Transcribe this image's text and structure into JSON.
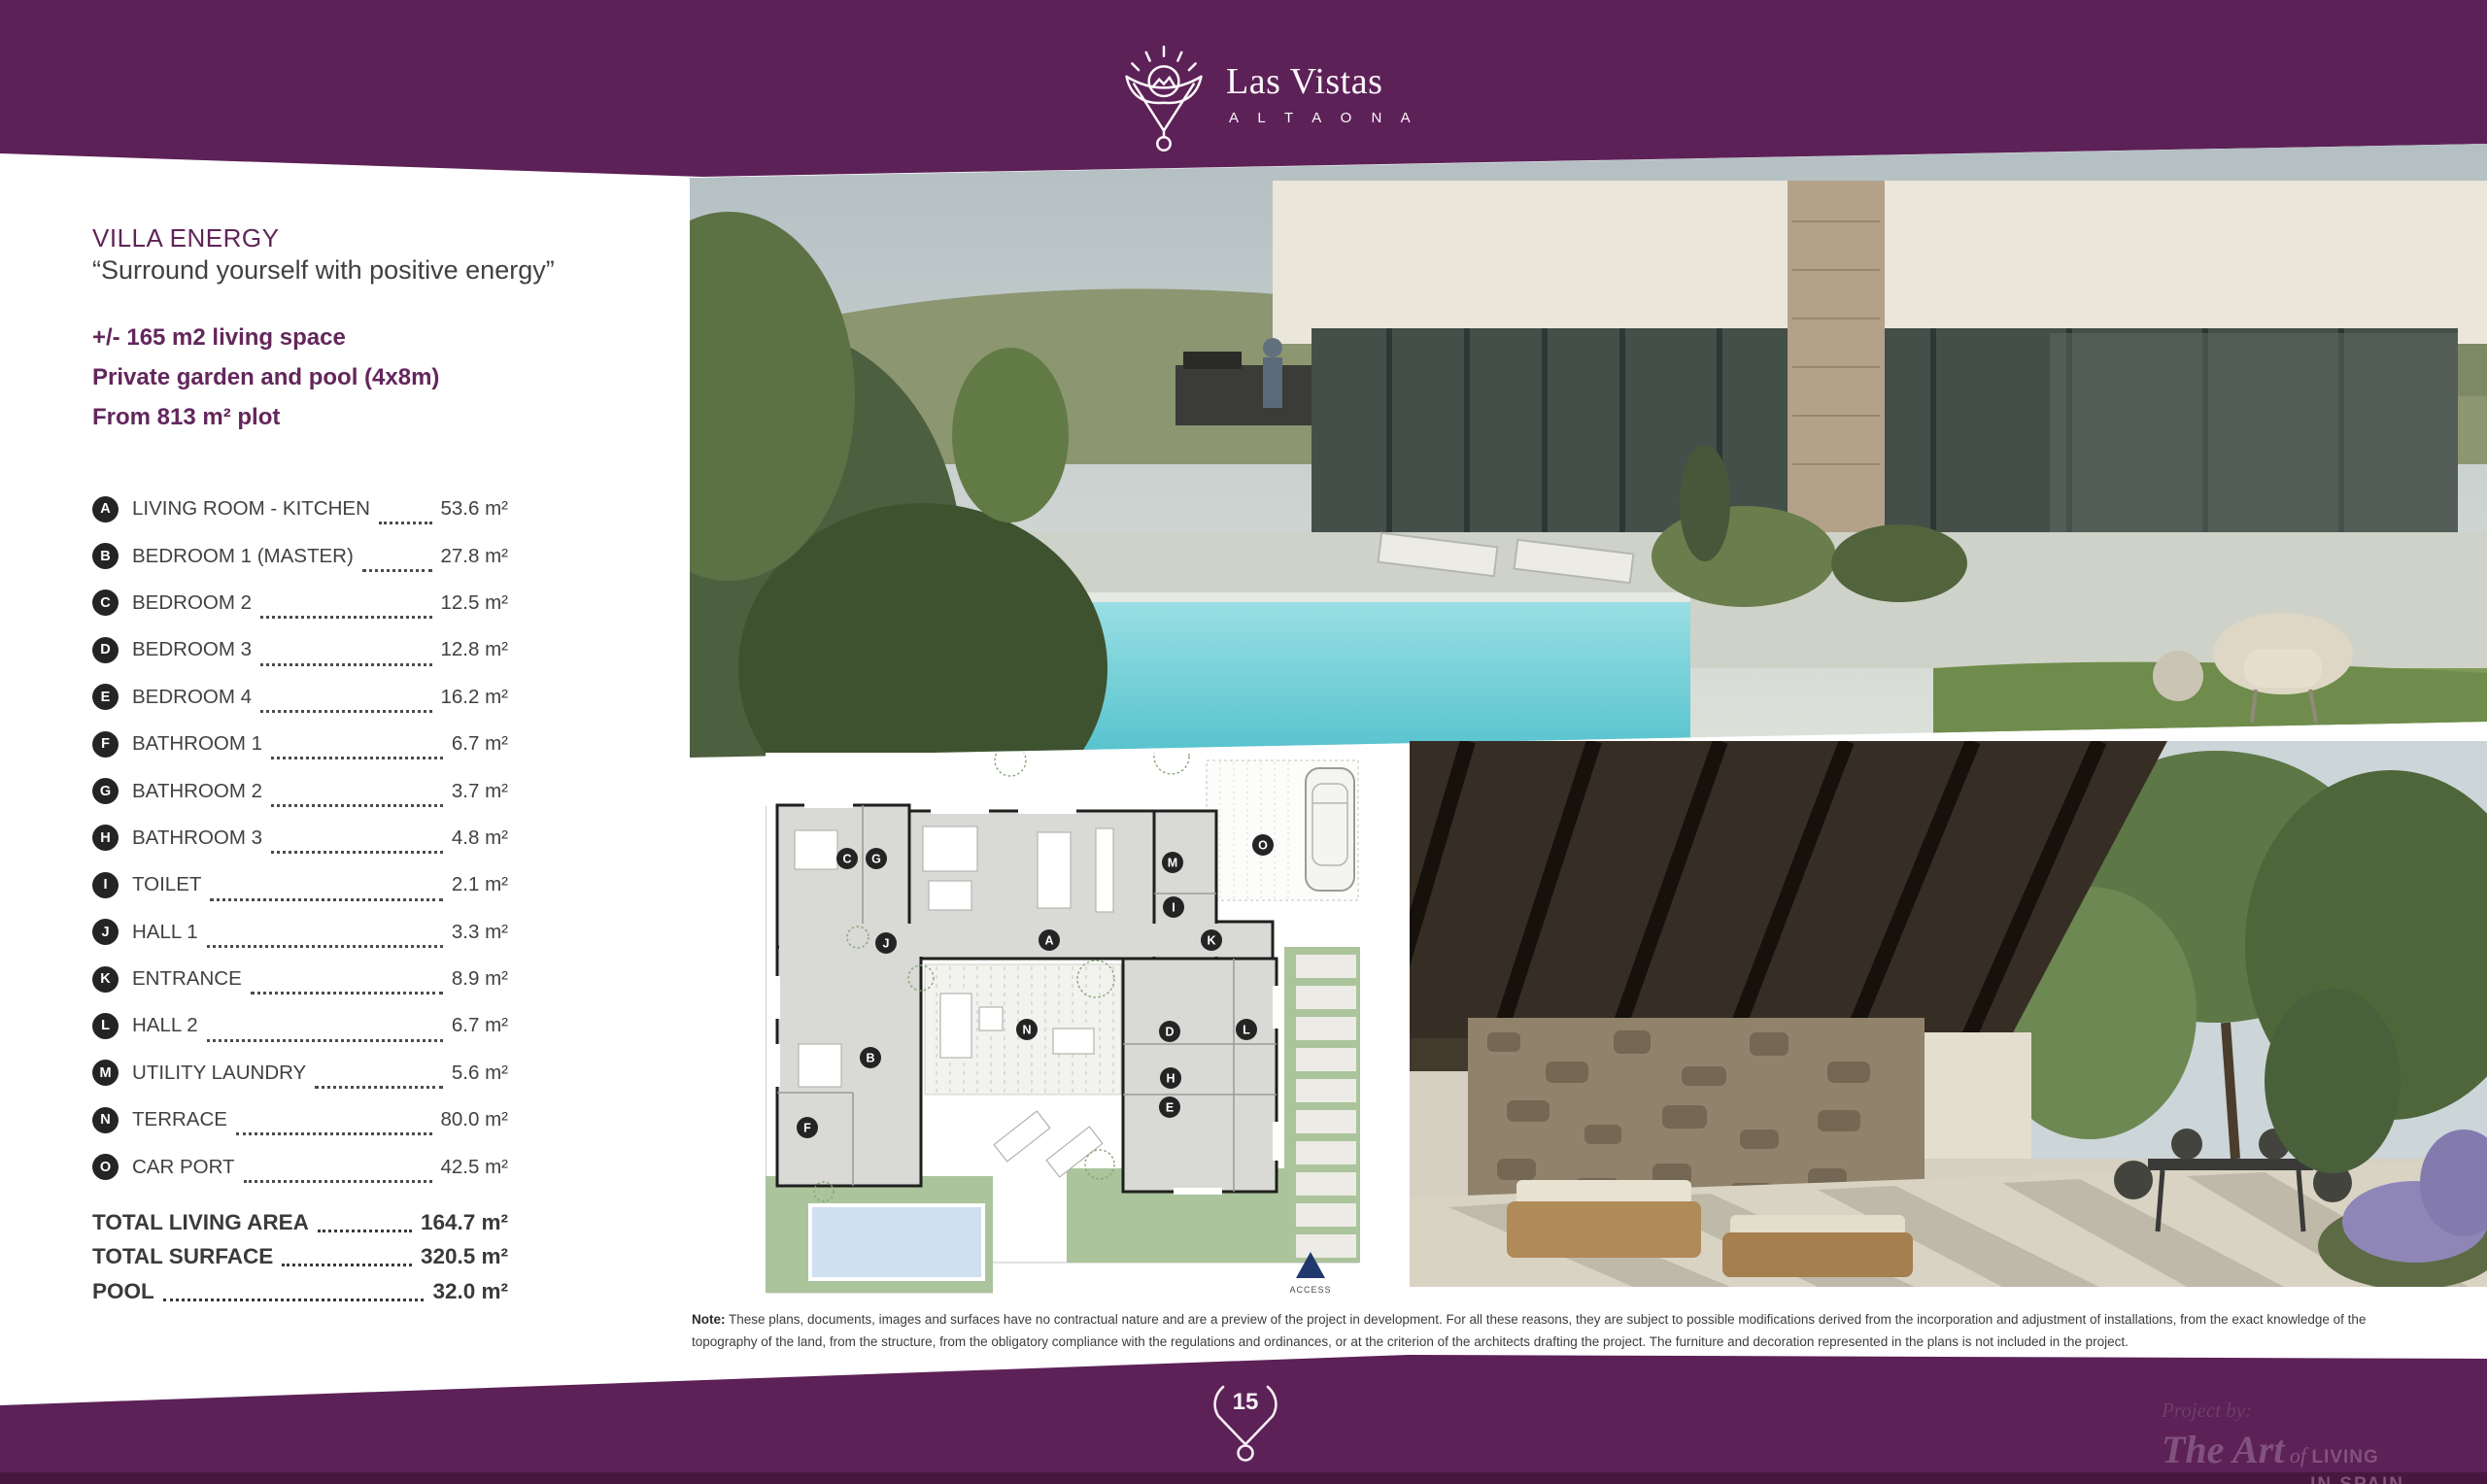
{
  "brand": {
    "name": "Las Vistas",
    "subname": "A L T A O N A"
  },
  "villa": {
    "title": "VILLA ENERGY",
    "tagline": "“Surround yourself with positive energy”",
    "highlights": [
      "+/- 165 m2 living space",
      "Private garden and pool (4x8m)",
      "From 813 m² plot"
    ]
  },
  "rooms": [
    {
      "key": "A",
      "label": "LIVING ROOM - KITCHEN",
      "area": "53.6 m²"
    },
    {
      "key": "B",
      "label": "BEDROOM 1 (MASTER)",
      "area": "27.8 m²"
    },
    {
      "key": "C",
      "label": "BEDROOM 2",
      "area": "12.5 m²"
    },
    {
      "key": "D",
      "label": "BEDROOM 3",
      "area": "12.8 m²"
    },
    {
      "key": "E",
      "label": "BEDROOM 4",
      "area": "16.2 m²"
    },
    {
      "key": "F",
      "label": "BATHROOM 1",
      "area": "6.7 m²"
    },
    {
      "key": "G",
      "label": "BATHROOM 2",
      "area": "3.7 m²"
    },
    {
      "key": "H",
      "label": "BATHROOM 3",
      "area": "4.8 m²"
    },
    {
      "key": "I",
      "label": "TOILET",
      "area": "2.1 m²"
    },
    {
      "key": "J",
      "label": "HALL 1",
      "area": "3.3 m²"
    },
    {
      "key": "K",
      "label": "ENTRANCE",
      "area": "8.9 m²"
    },
    {
      "key": "L",
      "label": "HALL 2",
      "area": "6.7 m²"
    },
    {
      "key": "M",
      "label": "UTILITY LAUNDRY",
      "area": "5.6 m²"
    },
    {
      "key": "N",
      "label": "TERRACE",
      "area": "80.0 m²"
    },
    {
      "key": "O",
      "label": "CAR PORT",
      "area": "42.5 m²"
    }
  ],
  "totals": [
    {
      "label": "TOTAL LIVING AREA",
      "value": "164.7 m²"
    },
    {
      "label": "TOTAL SURFACE",
      "value": "320.5 m²"
    },
    {
      "label": "POOL",
      "value": "32.0 m²"
    }
  ],
  "floorplan": {
    "access_label": "ACCESS"
  },
  "note": {
    "prefix": "Note:",
    "body": " These plans, documents, images and surfaces have no contractual nature and are a preview of the project in development. For all these reasons, they are subject to possible modifications derived from the incorporation and adjustment of installations, from the exact knowledge of the topography of the land, from the structure, from the obligatory compliance with the regulations and ordinances, or at the criterion of the architects drafting the project. The furniture and decoration represented in the plans is not included in the project."
  },
  "footer": {
    "page_number": "15",
    "project_by": "Project by:",
    "brand_script": "The Art",
    "brand_of": " of ",
    "brand_living": "LIVING",
    "brand_in_spain": "IN SPAIN"
  },
  "colors": {
    "purple": "#5c2157",
    "accent_text": "#63265c",
    "plan_green": "#abc49c",
    "pool_blue": "#cfe0f1",
    "access_navy": "#20386e"
  }
}
